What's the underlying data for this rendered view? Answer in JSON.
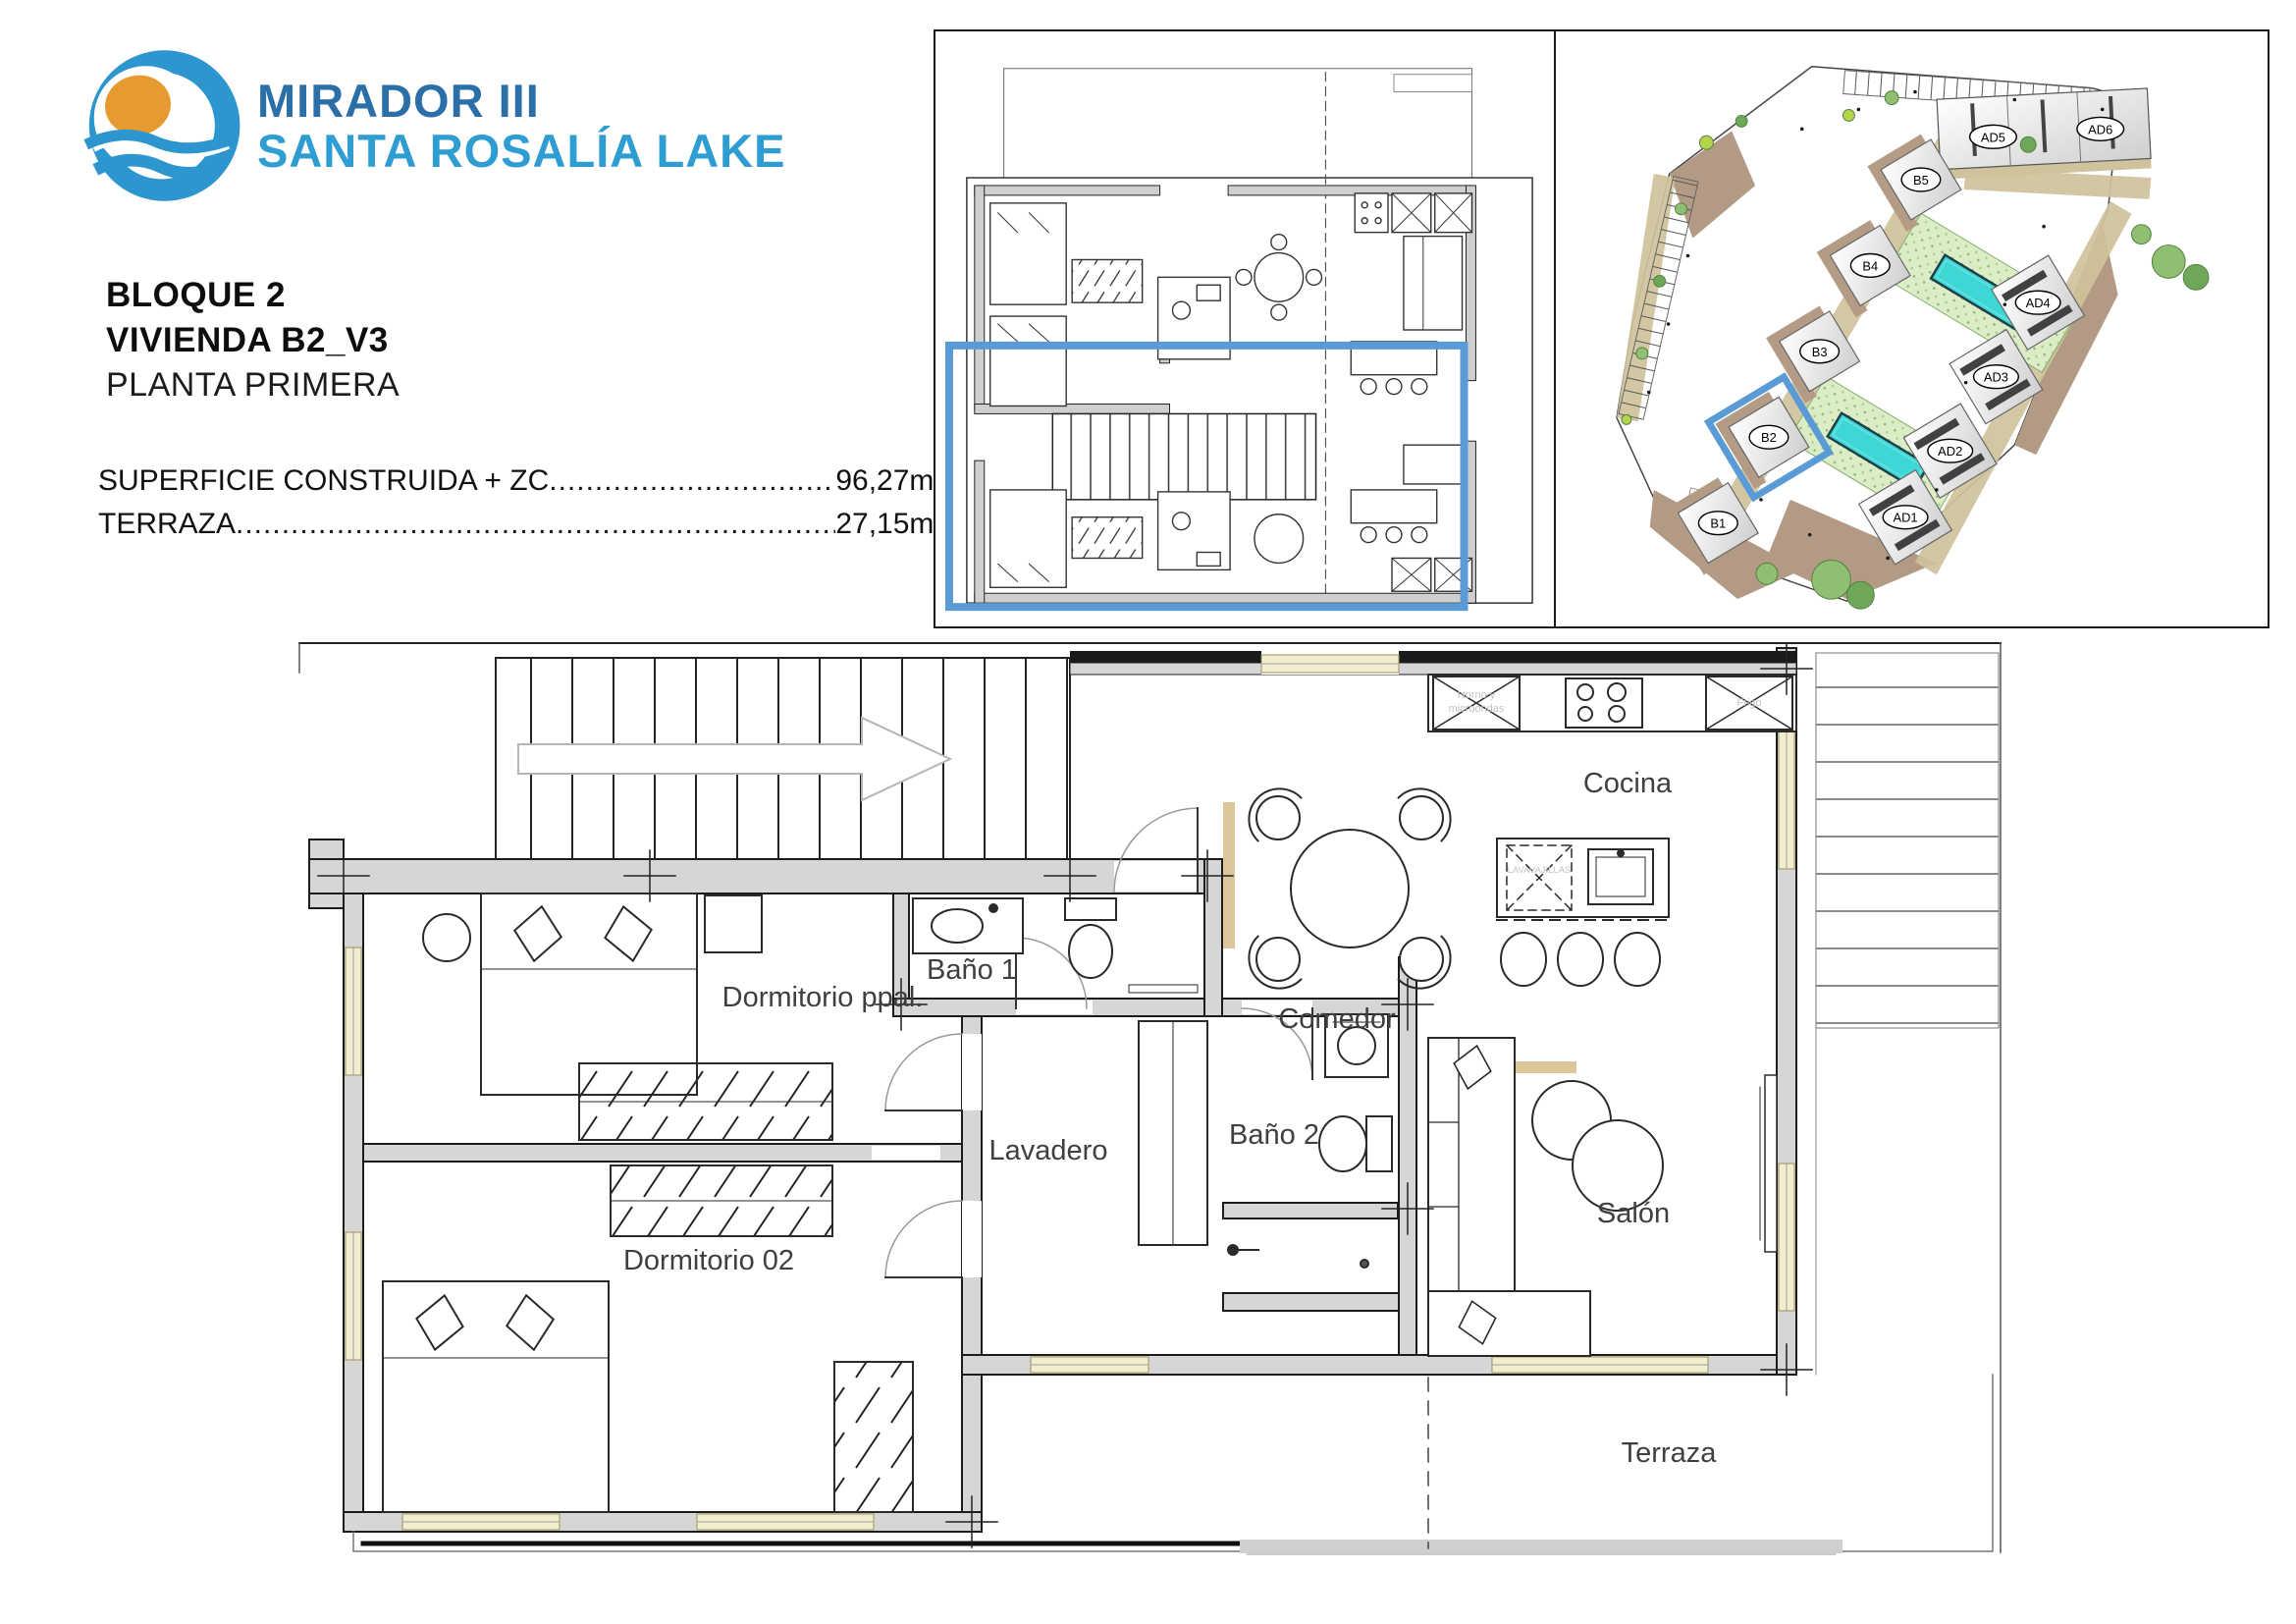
{
  "brand": {
    "title": "MIRADOR III",
    "subtitle": "SANTA ROSALÍA LAKE",
    "colors": {
      "title_blue": "#2b6fa8",
      "subtitle_blue": "#2e9dd2",
      "sun_orange": "#e59b2f",
      "wave_blue": "#2d96ce"
    }
  },
  "titles": {
    "block": "BLOQUE 2",
    "unit": "VIVIENDA B2_V3",
    "floor": "PLANTA PRIMERA"
  },
  "areas": [
    {
      "label": "SUPERFICIE CONSTRUIDA + ZC",
      "value": "96,27m",
      "sup": "2"
    },
    {
      "label": "TERRAZA",
      "value": "27,15m",
      "sup": "2"
    }
  ],
  "leader_dots": "........................................................................................................................................................",
  "key_plan": {
    "description": "duplex key plan with highlighted dwelling",
    "highlight_color": "#5B9BD5"
  },
  "site_plan": {
    "buildings": [
      {
        "id": "B1"
      },
      {
        "id": "B2"
      },
      {
        "id": "B3"
      },
      {
        "id": "B4"
      },
      {
        "id": "B5"
      },
      {
        "id": "AD1"
      },
      {
        "id": "AD2"
      },
      {
        "id": "AD3"
      },
      {
        "id": "AD4"
      },
      {
        "id": "AD5"
      },
      {
        "id": "AD6"
      }
    ],
    "highlighted_building": "B2",
    "colors": {
      "pool": "#3FD6D6",
      "lawn": "#dcecc7",
      "path": "#cfc39b",
      "earth": "#b29a85",
      "highlight": "#5B9BD5"
    }
  },
  "floor_plan": {
    "rooms": [
      {
        "name": "Baño 1"
      },
      {
        "name": "Dormitorio ppal."
      },
      {
        "name": "Dormitorio 02"
      },
      {
        "name": "Lavadero"
      },
      {
        "name": "Baño 2"
      },
      {
        "name": "Cocina"
      },
      {
        "name": "Comedor"
      },
      {
        "name": "Salón"
      },
      {
        "name": "Terraza"
      }
    ],
    "appliance_labels": {
      "oven_line1": "Horno y",
      "oven_line2": "microondas",
      "fridge": "Frigo",
      "dishwasher": "LAVAVAJILLAS"
    }
  }
}
